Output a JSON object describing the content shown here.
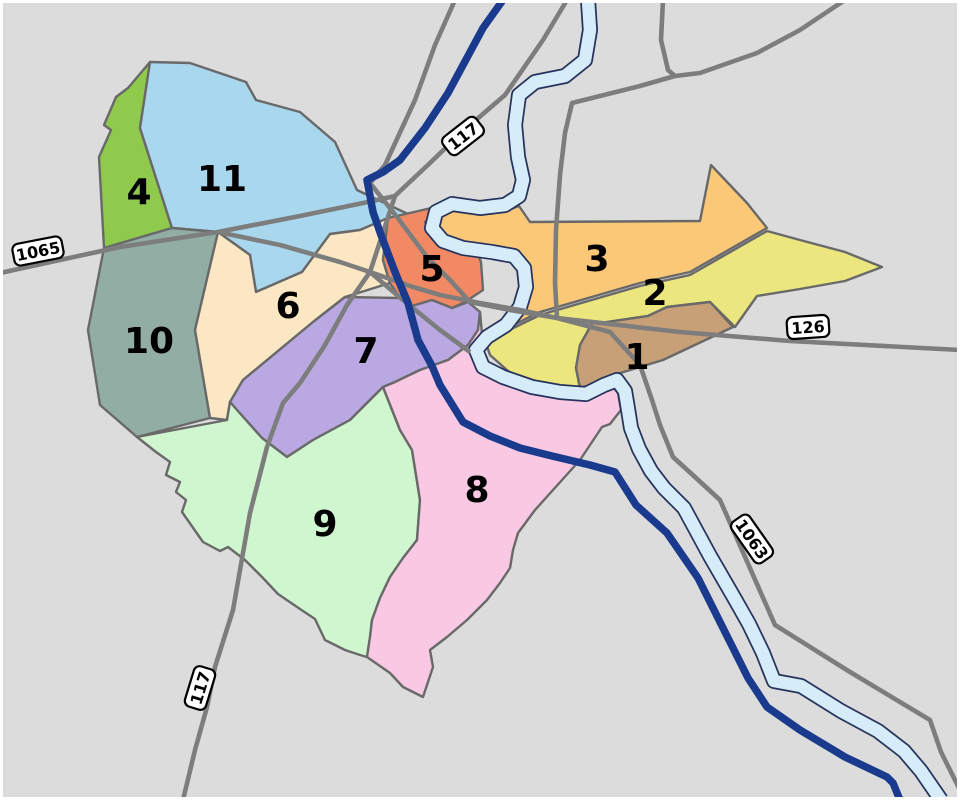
{
  "map": {
    "background_color": "#dcdcdc",
    "frame_color": "#ffffff",
    "district_border_color": "#696969",
    "road_color": "#7d7d7d",
    "motorway_color": "#1a3a8d",
    "river_color": "#d6edf9",
    "river_outline_color": "#27335c",
    "shield_background": "#ffffff",
    "shield_border": "#000000",
    "districts": [
      {
        "number": "1",
        "color": "#c8a077"
      },
      {
        "number": "2",
        "color": "#ece67e"
      },
      {
        "number": "3",
        "color": "#fbc878"
      },
      {
        "number": "4",
        "color": "#8fca4d"
      },
      {
        "number": "5",
        "color": "#f18a64"
      },
      {
        "number": "6",
        "color": "#fbe7c3"
      },
      {
        "number": "7",
        "color": "#b9a8e2"
      },
      {
        "number": "8",
        "color": "#f9c8e2"
      },
      {
        "number": "9",
        "color": "#d0f6d0"
      },
      {
        "number": "10",
        "color": "#92aea4"
      },
      {
        "number": "11",
        "color": "#a8d7ee"
      }
    ],
    "route_shields": [
      {
        "label": "1065"
      },
      {
        "label": "117"
      },
      {
        "label": "126"
      },
      {
        "label": "1063"
      },
      {
        "label": "117"
      }
    ]
  }
}
